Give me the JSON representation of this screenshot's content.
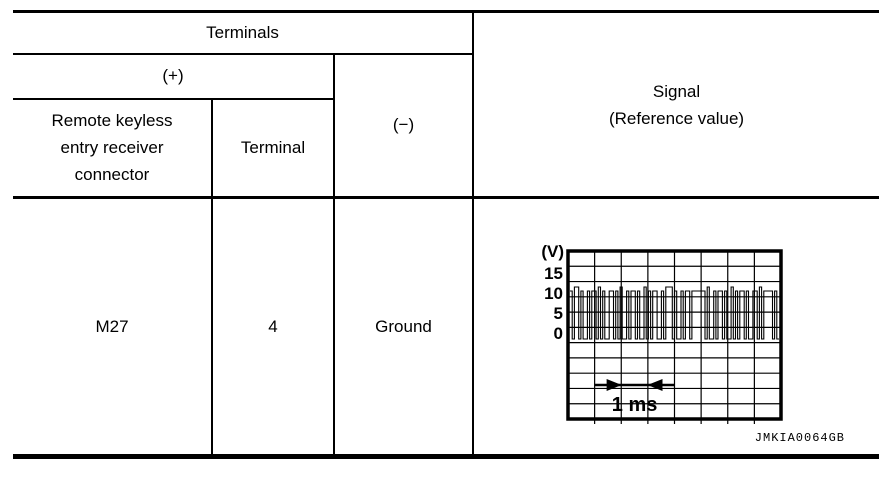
{
  "page": {
    "background": "#ffffff",
    "line_color": "#000000"
  },
  "table": {
    "header": {
      "terminals": "Terminals",
      "plus": "(+)",
      "connector_col": "Remote keyless entry receiver connector",
      "terminal_col": "Terminal",
      "minus": "(−)",
      "signal_line1": "Signal",
      "signal_line2": "(Reference value)"
    },
    "row": {
      "connector": "M27",
      "terminal": "4",
      "ground": "Ground"
    }
  },
  "figure_caption": "JMKIA0064GB",
  "chart_data": {
    "type": "line",
    "subtype": "oscilloscope-step-waveform",
    "title": "Signal (Reference value) waveform",
    "y_axis_label": "(V)",
    "y_ticks": [
      15,
      10,
      5,
      0
    ],
    "x_scale_label": "1 ms",
    "x_scale_divisions": 3,
    "grid": {
      "cols": 8,
      "rows": 11
    },
    "v_low": 0,
    "v_high": 12,
    "segments": [
      [
        1,
        12
      ],
      [
        1,
        0
      ],
      [
        2,
        13
      ],
      [
        1,
        0
      ],
      [
        1,
        12
      ],
      [
        2,
        0
      ],
      [
        1,
        12
      ],
      [
        1,
        0
      ],
      [
        2,
        12
      ],
      [
        1,
        0
      ],
      [
        1,
        13
      ],
      [
        1,
        0
      ],
      [
        1,
        12
      ],
      [
        2,
        0
      ],
      [
        2,
        12
      ],
      [
        1,
        0
      ],
      [
        1,
        12
      ],
      [
        1,
        0
      ],
      [
        1,
        13
      ],
      [
        2,
        0
      ],
      [
        1,
        12
      ],
      [
        1,
        0
      ],
      [
        2,
        12
      ],
      [
        1,
        0
      ],
      [
        1,
        12
      ],
      [
        2,
        0
      ],
      [
        1,
        13
      ],
      [
        1,
        0
      ],
      [
        1,
        12
      ],
      [
        1,
        0
      ],
      [
        2,
        12
      ],
      [
        2,
        0
      ],
      [
        1,
        12
      ],
      [
        1,
        0
      ],
      [
        3,
        13
      ],
      [
        1,
        0
      ],
      [
        1,
        12
      ],
      [
        2,
        0
      ],
      [
        1,
        12
      ],
      [
        1,
        0
      ],
      [
        2,
        12
      ],
      [
        1,
        0
      ],
      [
        6,
        12
      ],
      [
        1,
        0
      ],
      [
        1,
        13
      ],
      [
        2,
        0
      ],
      [
        1,
        12
      ],
      [
        1,
        0
      ],
      [
        2,
        12
      ],
      [
        1,
        0
      ],
      [
        1,
        12
      ],
      [
        2,
        0
      ],
      [
        1,
        13
      ],
      [
        1,
        0
      ],
      [
        1,
        12
      ],
      [
        1,
        0
      ],
      [
        2,
        12
      ],
      [
        1,
        0
      ],
      [
        1,
        12
      ],
      [
        2,
        0
      ],
      [
        2,
        12
      ],
      [
        1,
        0
      ],
      [
        1,
        13
      ],
      [
        1,
        0
      ],
      [
        4,
        12
      ],
      [
        1,
        0
      ],
      [
        1,
        12
      ],
      [
        1,
        0
      ]
    ]
  }
}
